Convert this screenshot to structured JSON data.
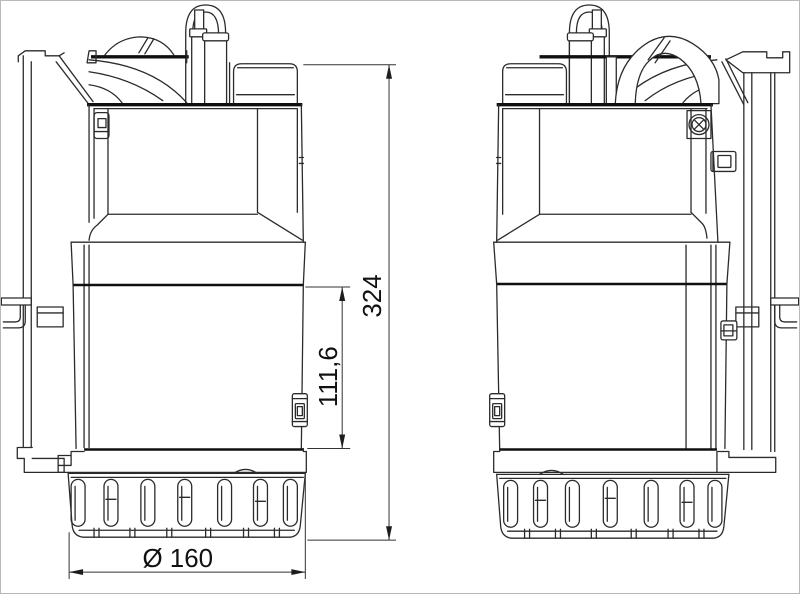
{
  "drawing": {
    "kind": "technical dimension drawing",
    "subject": "submersible pump, two side views",
    "background": "#ffffff",
    "line_color": "#2b2b2b",
    "thick_line_color": "#101010",
    "dimension_text_color": "#111111",
    "dimensions": {
      "overall_height": "324",
      "partial_height": "111,6",
      "base_diameter": "Ø 160"
    }
  }
}
